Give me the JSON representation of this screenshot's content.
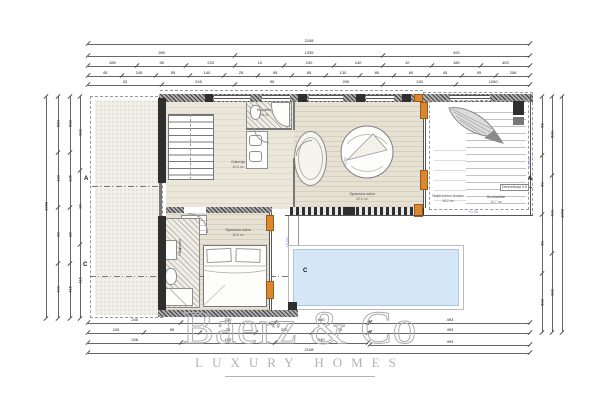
{
  "watermark": {
    "brand": "Baerz & Co",
    "tagline": "LUXURY HOMES"
  },
  "plan": {
    "rooms": [
      {
        "name": "Kupatilo",
        "area": "4.6 m²",
        "x": 264,
        "y": 108
      },
      {
        "name": "Galerija",
        "area": "10.8 m²",
        "x": 238,
        "y": 160
      },
      {
        "name": "Spavaća soba",
        "area": "22.0 m²",
        "x": 362,
        "y": 192
      },
      {
        "name": "Natkrivena terasa",
        "area": "18.2 m²",
        "x": 448,
        "y": 194
      },
      {
        "name": "Sunčalište",
        "area": "12.7 m²",
        "x": 496,
        "y": 195
      },
      {
        "name": "Spavaća soba",
        "area": "15.8 m²",
        "x": 238,
        "y": 228
      },
      {
        "name": "Kupatilo",
        "area": "5.2 m²",
        "x": 180,
        "y": 244,
        "rot": -90
      }
    ],
    "elevations": [
      {
        "text": "+0.00",
        "x": 468,
        "y": 209
      },
      {
        "text": "+0.00",
        "x": 340,
        "y": 160,
        "rot": -90
      },
      {
        "text": "+0.00",
        "x": 524,
        "y": 160,
        "rot": -90
      },
      {
        "text": "+0.00",
        "x": 282,
        "y": 240,
        "rot": -90
      }
    ],
    "sections": [
      {
        "label": "A",
        "x": 84,
        "y": 176
      },
      {
        "label": "C",
        "x": 83,
        "y": 262
      },
      {
        "label": "A",
        "x": 528,
        "y": 176
      },
      {
        "label": "C",
        "x": 303,
        "y": 268
      }
    ],
    "note": {
      "text": "Denivelacija 0.5",
      "x": 500,
      "y": 184
    }
  },
  "dimensions": {
    "rows": [
      {
        "o": "h",
        "x": 88,
        "y": 44,
        "len": 442,
        "labels": [
          "2108"
        ]
      },
      {
        "o": "h",
        "x": 88,
        "y": 56,
        "len": 442,
        "labels": [
          "280",
          "1335",
          "493"
        ]
      },
      {
        "o": "h",
        "x": 88,
        "y": 66,
        "len": 442,
        "labels": [
          "280",
          "95",
          "220",
          "10",
          "240",
          "140",
          "10",
          "180",
          "493"
        ]
      },
      {
        "o": "h",
        "x": 88,
        "y": 76,
        "len": 442,
        "labels": [
          "45",
          "245",
          "55",
          "140",
          "25",
          "95",
          "85",
          "130",
          "80",
          "60",
          "45",
          "95",
          "208"
        ]
      },
      {
        "o": "h",
        "x": 88,
        "y": 85,
        "len": 442,
        "labels": [
          "33",
          "245",
          "95",
          "200",
          "130",
          "1260"
        ]
      },
      {
        "o": "v",
        "x": 46,
        "y": 96,
        "len": 222,
        "labels": [
          "1068"
        ]
      },
      {
        "o": "v",
        "x": 58,
        "y": 96,
        "len": 222,
        "labels": [
          "550",
          "130",
          "80",
          "420"
        ]
      },
      {
        "o": "v",
        "x": 70,
        "y": 96,
        "len": 222,
        "labels": [
          "500",
          "135",
          "88",
          "415"
        ]
      },
      {
        "o": "v",
        "x": 80,
        "y": 96,
        "len": 222,
        "labels": [
          "200",
          "26",
          "415"
        ]
      },
      {
        "o": "v",
        "x": 542,
        "y": 96,
        "len": 236,
        "labels": [
          "65",
          "50",
          "60",
          "500"
        ]
      },
      {
        "o": "v",
        "x": 552,
        "y": 96,
        "len": 236,
        "labels": [
          "500",
          "420",
          "200"
        ]
      },
      {
        "o": "v",
        "x": 562,
        "y": 96,
        "len": 236,
        "labels": [
          "1068"
        ]
      },
      {
        "o": "h",
        "x": 88,
        "y": 323,
        "len": 280,
        "labels": [
          "245",
          "230",
          "640"
        ]
      },
      {
        "o": "h",
        "x": 370,
        "y": 323,
        "len": 160,
        "labels": [
          "493"
        ]
      },
      {
        "o": "h",
        "x": 88,
        "y": 333,
        "len": 280,
        "labels": [
          "240",
          "95",
          "20",
          "330",
          "70"
        ]
      },
      {
        "o": "h",
        "x": 370,
        "y": 333,
        "len": 160,
        "labels": [
          "493"
        ]
      },
      {
        "o": "h",
        "x": 88,
        "y": 343,
        "len": 280,
        "labels": [
          "246",
          "100",
          "640"
        ]
      },
      {
        "o": "h",
        "x": 370,
        "y": 345,
        "len": 160,
        "labels": [
          "493"
        ]
      },
      {
        "o": "h",
        "x": 88,
        "y": 353,
        "len": 442,
        "labels": [
          "2108"
        ]
      }
    ]
  },
  "colors": {
    "pool": "#d5e7f6",
    "accent_orange": "#dd8630",
    "watermark_gray": "#aeacb0",
    "elevation_blue": "#7b86c8"
  }
}
